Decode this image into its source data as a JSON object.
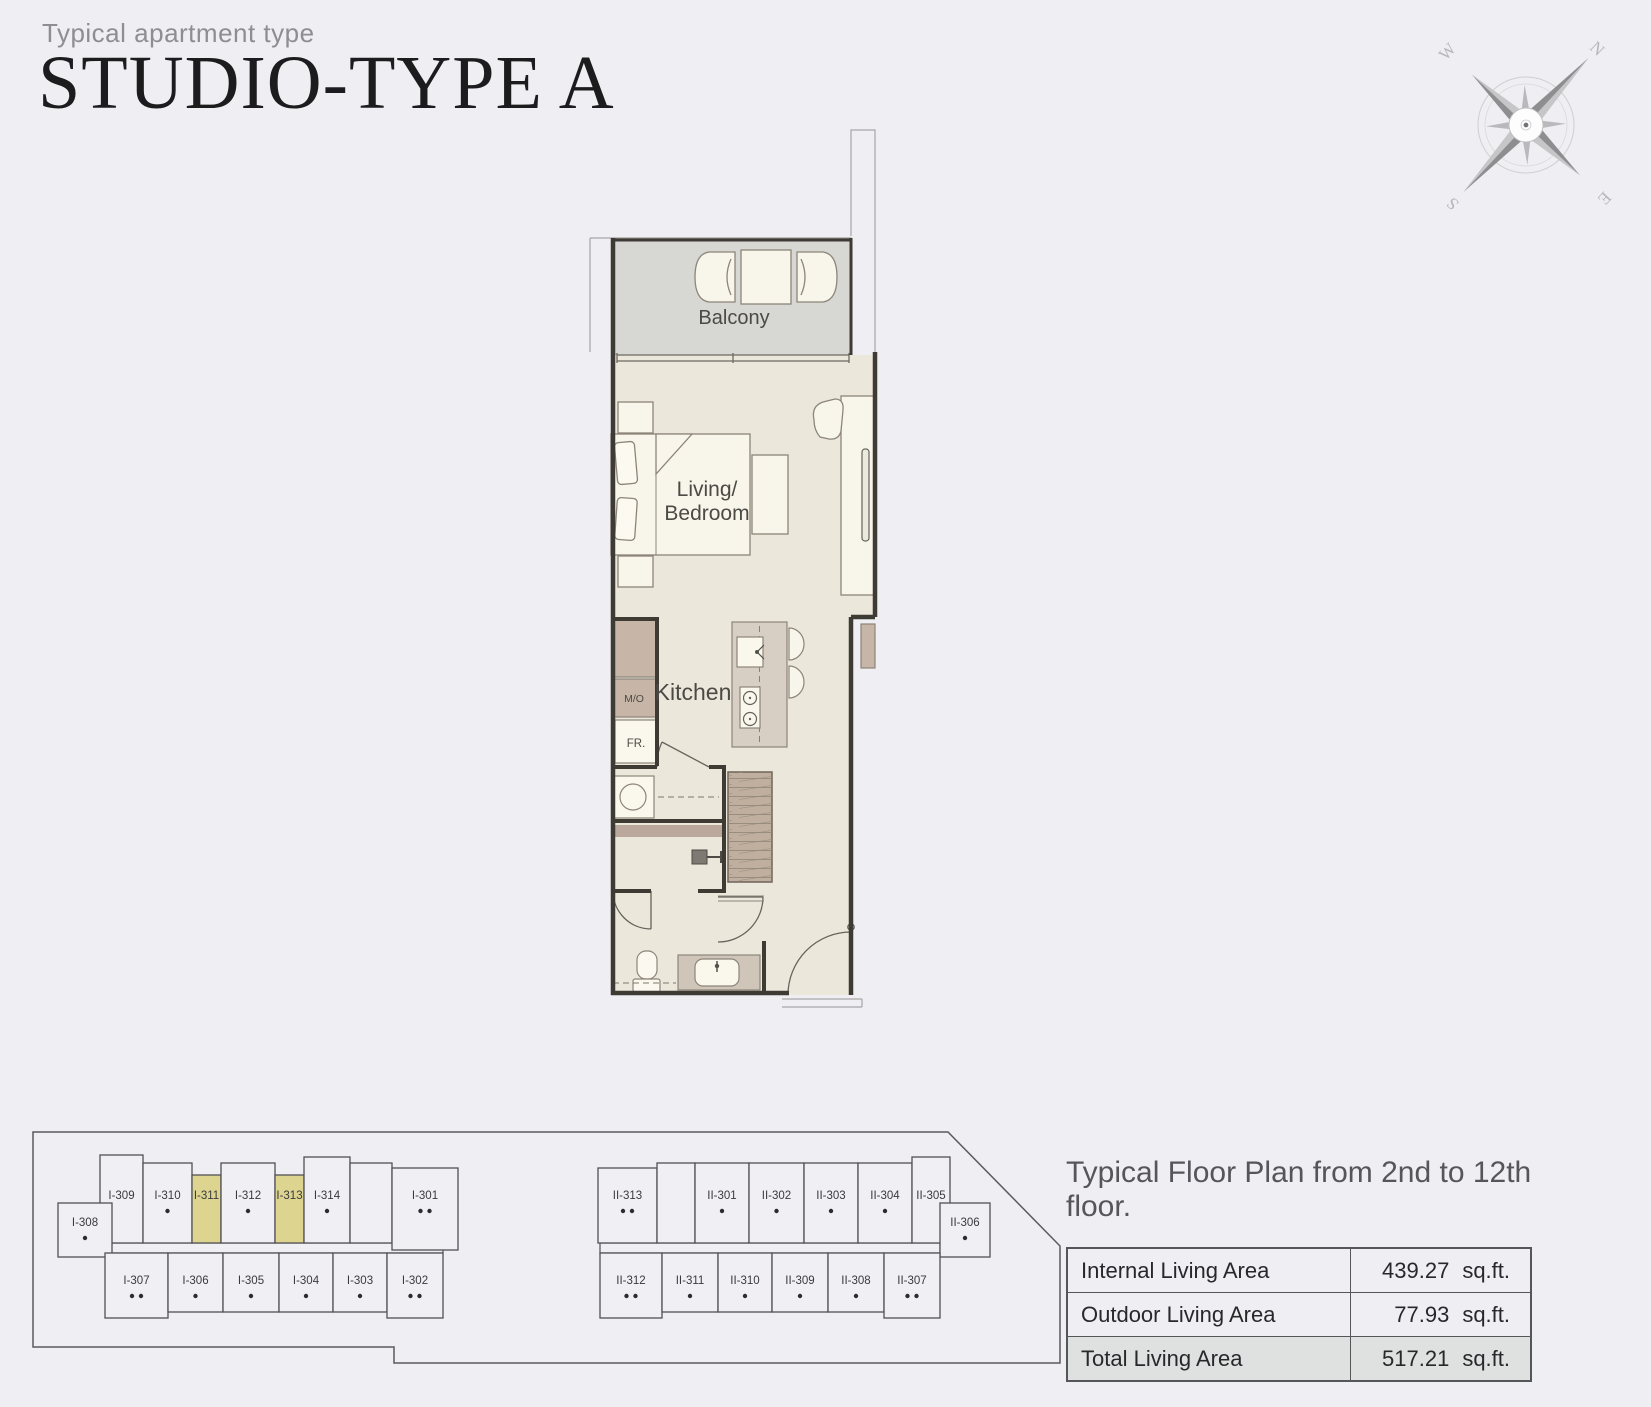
{
  "page": {
    "background": "#efeef2"
  },
  "header": {
    "eyebrow": "Typical apartment type",
    "title": "STUDIO-TYPE A"
  },
  "compass": {
    "letters": {
      "n": "N",
      "e": "E",
      "s": "S",
      "w": "W"
    }
  },
  "floor_plan": {
    "labels": {
      "balcony": "Balcony",
      "living_line1": "Living/",
      "living_line2": "Bedroom",
      "kitchen": "Kitchen",
      "microwave_oven": "M/O",
      "fridge": "FR."
    },
    "colors": {
      "room": "#ece7db",
      "balcony": "#d7d7d3",
      "furniture": "#f8f5ea",
      "cabinet": "#c7b5a8",
      "island": "#d8cfc4",
      "wardrobe": "#c0ae9f",
      "counter": "#cfc5b8",
      "accent_band": "#b9a89b",
      "wall": "#3e3a34"
    }
  },
  "key_plan": {
    "cell_fill": "#f0eff3",
    "highlight_fill": "#ddd48f",
    "line_color": "#515156",
    "buildings": [
      {
        "id": "building-1",
        "units": [
          {
            "label": "I-309",
            "row": "top",
            "x0": 100,
            "x1": 143,
            "y0": 1155,
            "dots": 0
          },
          {
            "label": "I-310",
            "row": "top",
            "x0": 143,
            "x1": 192,
            "dots": 1
          },
          {
            "label": "I-311",
            "row": "top",
            "x0": 192,
            "x1": 221,
            "y0": 1175,
            "dots": 0,
            "highlighted": true
          },
          {
            "label": "I-312",
            "row": "top",
            "x0": 221,
            "x1": 275,
            "dots": 1
          },
          {
            "label": "I-313",
            "row": "top",
            "x0": 275,
            "x1": 304,
            "y0": 1175,
            "dots": 0,
            "highlighted": true
          },
          {
            "label": "I-314",
            "row": "top",
            "x0": 304,
            "x1": 350,
            "y0": 1157,
            "dots": 1
          },
          {
            "label": "",
            "row": "top",
            "x0": 350,
            "x1": 392,
            "dots": 0
          },
          {
            "label": "I-301",
            "row": "top",
            "x0": 392,
            "x1": 458,
            "y0": 1168,
            "y1": 1250,
            "dots": 2
          },
          {
            "label": "I-308",
            "row": "side",
            "x0": 58,
            "x1": 112,
            "dots": 1
          },
          {
            "label": "I-307",
            "row": "bottom",
            "x0": 105,
            "x1": 168,
            "y1": 1318,
            "dots": 2
          },
          {
            "label": "I-306",
            "row": "bottom",
            "x0": 168,
            "x1": 223,
            "dots": 1
          },
          {
            "label": "I-305",
            "row": "bottom",
            "x0": 223,
            "x1": 279,
            "dots": 1
          },
          {
            "label": "I-304",
            "row": "bottom",
            "x0": 279,
            "x1": 333,
            "dots": 1
          },
          {
            "label": "I-303",
            "row": "bottom",
            "x0": 333,
            "x1": 387,
            "dots": 1
          },
          {
            "label": "I-302",
            "row": "bottom",
            "x0": 387,
            "x1": 443,
            "y1": 1318,
            "dots": 2
          }
        ]
      },
      {
        "id": "building-2",
        "units": [
          {
            "label": "II-313",
            "row": "top",
            "x0": 598,
            "x1": 657,
            "y0": 1168,
            "dots": 2
          },
          {
            "label": "",
            "row": "top",
            "x0": 657,
            "x1": 695,
            "dots": 0
          },
          {
            "label": "II-301",
            "row": "top",
            "x0": 695,
            "x1": 749,
            "dots": 1
          },
          {
            "label": "II-302",
            "row": "top",
            "x0": 749,
            "x1": 804,
            "dots": 1
          },
          {
            "label": "II-303",
            "row": "top",
            "x0": 804,
            "x1": 858,
            "dots": 1
          },
          {
            "label": "II-304",
            "row": "top",
            "x0": 858,
            "x1": 912,
            "dots": 1
          },
          {
            "label": "II-305",
            "row": "top",
            "x0": 912,
            "x1": 950,
            "y0": 1157,
            "dots": 0
          },
          {
            "label": "II-306",
            "row": "side",
            "x0": 940,
            "x1": 990,
            "dots": 1
          },
          {
            "label": "II-312",
            "row": "bottom",
            "x0": 600,
            "x1": 662,
            "y1": 1318,
            "dots": 2
          },
          {
            "label": "II-311",
            "row": "bottom",
            "x0": 662,
            "x1": 718,
            "dots": 1
          },
          {
            "label": "II-310",
            "row": "bottom",
            "x0": 718,
            "x1": 772,
            "dots": 1
          },
          {
            "label": "II-309",
            "row": "bottom",
            "x0": 772,
            "x1": 828,
            "dots": 1
          },
          {
            "label": "II-308",
            "row": "bottom",
            "x0": 828,
            "x1": 884,
            "dots": 1
          },
          {
            "label": "II-307",
            "row": "bottom",
            "x0": 884,
            "x1": 940,
            "y1": 1318,
            "dots": 2
          }
        ]
      }
    ]
  },
  "summary": {
    "caption": "Typical Floor Plan from 2nd to 12th floor.",
    "rows": [
      {
        "label": "Internal Living Area",
        "value": "439.27",
        "unit": "sq.ft.",
        "emphasis": false
      },
      {
        "label": "Outdoor Living Area",
        "value": "77.93",
        "unit": "sq.ft.",
        "emphasis": false
      },
      {
        "label": "Total Living Area",
        "value": "517.21",
        "unit": "sq.ft.",
        "emphasis": true
      }
    ]
  }
}
